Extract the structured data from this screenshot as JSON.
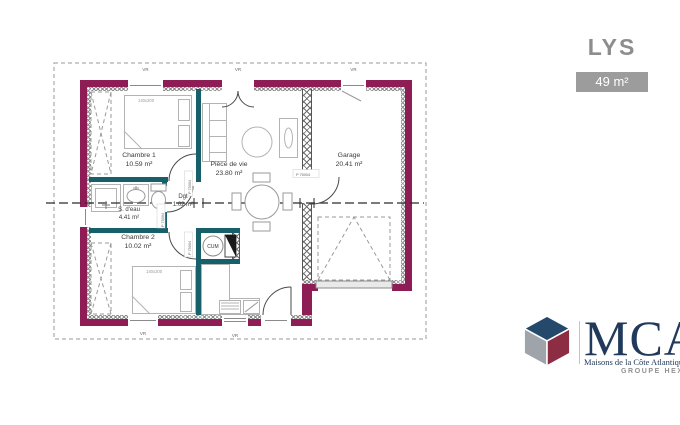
{
  "header": {
    "model_name": "LYS",
    "area_badge": "49 m²"
  },
  "floorplan": {
    "rooms": [
      {
        "label": "Chambre 1",
        "area": "10.59 m²"
      },
      {
        "label": "S. d'eau",
        "area": "4.41 m²"
      },
      {
        "label": "Chambre 2",
        "area": "10.02 m²"
      },
      {
        "label": "Dgt",
        "area": "1.02 m²"
      },
      {
        "label": "Pièce de vie",
        "area": "23.80 m²"
      },
      {
        "label": "Garage",
        "area": "20.41 m²"
      }
    ],
    "annotations": {
      "bed_size": "140x200",
      "water_heater": "CUM",
      "door_code": "P 75004",
      "shutter_label": "VR"
    },
    "colors": {
      "exterior_wall": "#8E1C55",
      "interior_wall": "#176069"
    }
  },
  "branding": {
    "logo_text": "MCA",
    "tagline": "Maisons de la Côte Atlantique",
    "group_label": "GROUPE HEXAOM",
    "colors": {
      "navy": "#21395B",
      "red": "#8C2D43",
      "gray": "#9EA4AA"
    }
  }
}
